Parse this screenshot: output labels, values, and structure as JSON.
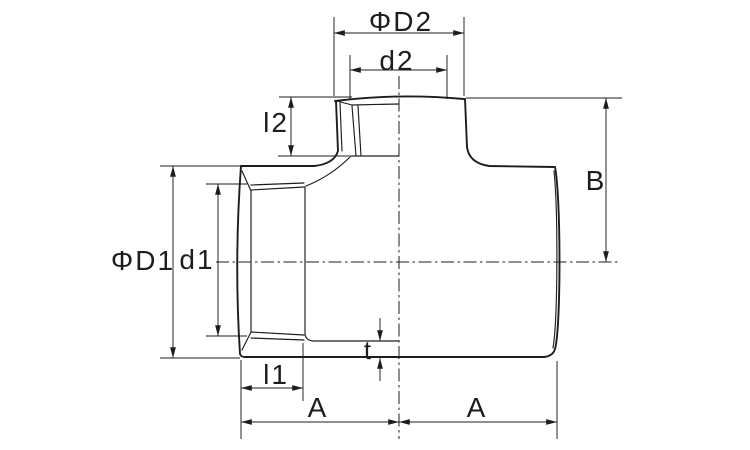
{
  "drawing": {
    "type": "reducing-tee-dimension-drawing",
    "colors": {
      "line": "#1d1d1d",
      "background": "#ffffff"
    },
    "labels": {
      "phi_d2": "ΦD2",
      "d2": "d2",
      "l2": "l2",
      "b": "B",
      "phi_d1": "ΦD1",
      "d1": "d1",
      "t": "t",
      "l1": "l1",
      "a_left": "A",
      "a_right": "A"
    }
  }
}
